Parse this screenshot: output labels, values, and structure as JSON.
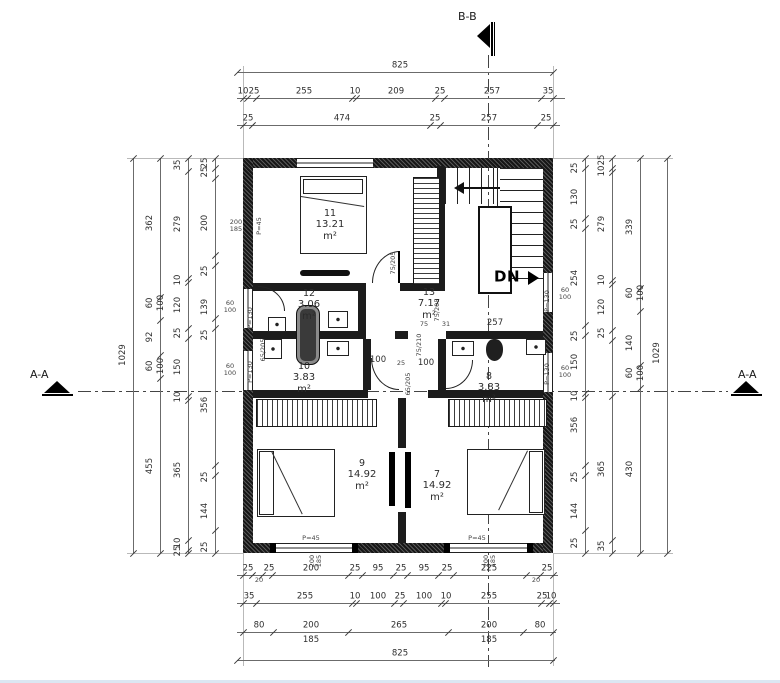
{
  "sections": {
    "bb": "B-B",
    "aa_left": "A-A",
    "aa_right": "A-A"
  },
  "colors": {
    "wall": "#161616",
    "dim_line": "#6b6b6b",
    "text": "#2e2e2e"
  },
  "stair": {
    "direction_label": "DN"
  },
  "rooms": [
    {
      "num": "11",
      "area": "13.21 m²",
      "x": 330,
      "y": 208
    },
    {
      "num": "12",
      "area": "3.06 m²",
      "x": 309,
      "y": 288
    },
    {
      "num": "13",
      "area": "7.17 m²",
      "x": 429,
      "y": 287
    },
    {
      "num": "10",
      "area": "3.83 m²",
      "x": 304,
      "y": 361
    },
    {
      "num": "8",
      "area": "3.83 m²",
      "x": 489,
      "y": 371
    },
    {
      "num": "9",
      "area": "14.92 m²",
      "x": 362,
      "y": 458
    },
    {
      "num": "7",
      "area": "14.92 m²",
      "x": 437,
      "y": 469
    }
  ],
  "dims": {
    "h": [
      {
        "y": 72,
        "x1": 237,
        "x2": 553,
        "ticks": [
          237,
          553
        ],
        "labels": [
          {
            "t": "825",
            "x": 400
          }
        ]
      },
      {
        "y": 98,
        "x1": 237,
        "x2": 565,
        "ticks": [
          243,
          247,
          256,
          352,
          356,
          435,
          444,
          541,
          553
        ],
        "labels": [
          {
            "t": "10",
            "x": 243
          },
          {
            "t": "25",
            "x": 254
          },
          {
            "t": "255",
            "x": 304
          },
          {
            "t": "10",
            "x": 355
          },
          {
            "t": "209",
            "x": 396
          },
          {
            "t": "25",
            "x": 440
          },
          {
            "t": "257",
            "x": 492
          },
          {
            "t": "35",
            "x": 548
          }
        ]
      },
      {
        "y": 125,
        "x1": 237,
        "x2": 560,
        "ticks": [
          243,
          252,
          430,
          440,
          537,
          553
        ],
        "labels": [
          {
            "t": "25",
            "x": 248
          },
          {
            "t": "474",
            "x": 342
          },
          {
            "t": "25",
            "x": 435
          },
          {
            "t": "257",
            "x": 489
          },
          {
            "t": "25",
            "x": 546
          }
        ]
      },
      {
        "y": 575,
        "x1": 237,
        "x2": 558,
        "ticks": [
          243,
          252,
          262,
          272,
          348,
          362,
          393,
          407,
          438,
          453,
          526,
          540,
          553
        ],
        "labels": [
          {
            "t": "25",
            "x": 248
          },
          {
            "t": "20",
            "x": 259,
            "dy": 2,
            "s": 1
          },
          {
            "t": "25",
            "x": 269
          },
          {
            "t": "200",
            "x": 311
          },
          {
            "t": "25",
            "x": 355
          },
          {
            "t": "95",
            "x": 378
          },
          {
            "t": "25",
            "x": 401
          },
          {
            "t": "95",
            "x": 424
          },
          {
            "t": "25",
            "x": 447
          },
          {
            "t": "225",
            "x": 489
          },
          {
            "t": "20",
            "x": 536,
            "dy": 2,
            "s": 1
          },
          {
            "t": "25",
            "x": 547
          }
        ]
      },
      {
        "y": 603,
        "x1": 237,
        "x2": 560,
        "ticks": [
          243,
          256,
          352,
          356,
          394,
          403,
          441,
          445,
          541,
          549,
          553
        ],
        "labels": [
          {
            "t": "35",
            "x": 249
          },
          {
            "t": "255",
            "x": 305
          },
          {
            "t": "10",
            "x": 355
          },
          {
            "t": "100",
            "x": 378
          },
          {
            "t": "25",
            "x": 400
          },
          {
            "t": "100",
            "x": 424
          },
          {
            "t": "10",
            "x": 446
          },
          {
            "t": "255",
            "x": 489
          },
          {
            "t": "25",
            "x": 542
          },
          {
            "t": "10",
            "x": 551
          }
        ]
      },
      {
        "y": 632,
        "x1": 237,
        "x2": 556,
        "ticks": [
          243,
          273,
          348,
          448,
          523,
          553
        ],
        "labels": [
          {
            "t": "80",
            "x": 259
          },
          {
            "t": "200",
            "x": 311
          },
          {
            "t": "185",
            "x": 311,
            "dy": 4
          },
          {
            "t": "265",
            "x": 399
          },
          {
            "t": "200",
            "x": 489
          },
          {
            "t": "185",
            "x": 489,
            "dy": 4
          },
          {
            "t": "80",
            "x": 540
          }
        ]
      },
      {
        "y": 660,
        "x1": 237,
        "x2": 555,
        "ticks": [
          237,
          553
        ],
        "labels": [
          {
            "t": "825",
            "x": 400
          }
        ]
      }
    ],
    "v": [
      {
        "x": 133,
        "y1": 158,
        "y2": 553,
        "ticks": [
          158,
          553
        ],
        "labels": [
          {
            "t": "1029",
            "y": 355
          }
        ]
      },
      {
        "x": 160,
        "y1": 158,
        "y2": 553,
        "ticks": [
          158,
          297,
          320,
          355,
          378,
          553
        ],
        "labels": [
          {
            "t": "362",
            "y": 223
          },
          {
            "t": "60",
            "y": 303
          },
          {
            "t": "100",
            "y": 303,
            "dx": 11
          },
          {
            "t": "92",
            "y": 337
          },
          {
            "t": "60",
            "y": 366
          },
          {
            "t": "100",
            "y": 366,
            "dx": 11
          },
          {
            "t": "455",
            "y": 466
          }
        ]
      },
      {
        "x": 188,
        "y1": 158,
        "y2": 553,
        "ticks": [
          158,
          171,
          278,
          282,
          328,
          338,
          396,
          400,
          540,
          550,
          553
        ],
        "labels": [
          {
            "t": "35",
            "y": 165
          },
          {
            "t": "279",
            "y": 224
          },
          {
            "t": "10",
            "y": 280
          },
          {
            "t": "120",
            "y": 305
          },
          {
            "t": "25",
            "y": 333
          },
          {
            "t": "150",
            "y": 367
          },
          {
            "t": "10",
            "y": 397
          },
          {
            "t": "365",
            "y": 470
          },
          {
            "t": "10",
            "y": 543
          },
          {
            "t": "25",
            "y": 551
          }
        ]
      },
      {
        "x": 215,
        "y1": 158,
        "y2": 553,
        "ticks": [
          158,
          168,
          178,
          255,
          265,
          318,
          328,
          465,
          475,
          530,
          553
        ],
        "labels": [
          {
            "t": "25",
            "y": 163
          },
          {
            "t": "25",
            "y": 172
          },
          {
            "t": "200",
            "y": 223
          },
          {
            "t": "25",
            "y": 271
          },
          {
            "t": "139",
            "y": 307
          },
          {
            "t": "25",
            "y": 335
          },
          {
            "t": "356",
            "y": 405
          },
          {
            "t": "25",
            "y": 477
          },
          {
            "t": "144",
            "y": 511
          },
          {
            "t": "25",
            "y": 547
          }
        ]
      },
      {
        "x": 585,
        "y1": 158,
        "y2": 553,
        "ticks": [
          158,
          168,
          218,
          228,
          325,
          335,
          393,
          397,
          465,
          475,
          530,
          553
        ],
        "labels": [
          {
            "t": "25",
            "y": 168
          },
          {
            "t": "130",
            "y": 197
          },
          {
            "t": "25",
            "y": 224
          },
          {
            "t": "254",
            "y": 278
          },
          {
            "t": "25",
            "y": 336
          },
          {
            "t": "150",
            "y": 362
          },
          {
            "t": "10",
            "y": 396
          },
          {
            "t": "356",
            "y": 425
          },
          {
            "t": "25",
            "y": 477
          },
          {
            "t": "144",
            "y": 511
          },
          {
            "t": "25",
            "y": 543
          }
        ]
      },
      {
        "x": 612,
        "y1": 158,
        "y2": 553,
        "ticks": [
          158,
          168,
          172,
          280,
          284,
          330,
          340,
          396,
          540,
          553
        ],
        "labels": [
          {
            "t": "25",
            "y": 160
          },
          {
            "t": "10",
            "y": 171
          },
          {
            "t": "279",
            "y": 224
          },
          {
            "t": "10",
            "y": 280
          },
          {
            "t": "120",
            "y": 307
          },
          {
            "t": "25",
            "y": 333
          },
          {
            "t": "365",
            "y": 469
          },
          {
            "t": "35",
            "y": 546
          }
        ]
      },
      {
        "x": 640,
        "y1": 158,
        "y2": 553,
        "ticks": [
          158,
          288,
          311,
          365,
          388,
          553
        ],
        "labels": [
          {
            "t": "339",
            "y": 227
          },
          {
            "t": "60",
            "y": 293
          },
          {
            "t": "100",
            "y": 293,
            "dx": 11
          },
          {
            "t": "140",
            "y": 343
          },
          {
            "t": "60",
            "y": 373
          },
          {
            "t": "100",
            "y": 373,
            "dx": 11
          },
          {
            "t": "430",
            "y": 469
          }
        ]
      },
      {
        "x": 667,
        "y1": 158,
        "y2": 553,
        "ticks": [
          158,
          553
        ],
        "labels": [
          {
            "t": "1029",
            "y": 353
          }
        ]
      }
    ]
  },
  "labels": [
    {
      "t": "257",
      "x": 495,
      "y": 323
    },
    {
      "t": "75",
      "x": 424,
      "y": 324,
      "s": 1
    },
    {
      "t": "31",
      "x": 446,
      "y": 324,
      "s": 1
    },
    {
      "t": "100",
      "x": 378,
      "y": 360
    },
    {
      "t": "25",
      "x": 401,
      "y": 363,
      "s": 1
    },
    {
      "t": "100",
      "x": 426,
      "y": 363
    },
    {
      "t": "P=45",
      "x": 259,
      "y": 226,
      "r": 1,
      "s": 1
    },
    {
      "t": "P=130",
      "x": 250,
      "y": 318,
      "r": 1,
      "s": 1
    },
    {
      "t": "P=130",
      "x": 250,
      "y": 372,
      "r": 1,
      "s": 1
    },
    {
      "t": "P=130",
      "x": 547,
      "y": 301,
      "r": 1,
      "s": 1
    },
    {
      "t": "P=130",
      "x": 547,
      "y": 374,
      "r": 1,
      "s": 1
    },
    {
      "t": "P=45",
      "x": 311,
      "y": 538,
      "s": 1
    },
    {
      "t": "P=45",
      "x": 477,
      "y": 538,
      "s": 1
    },
    {
      "t": "200",
      "x": 236,
      "y": 222,
      "s": 1
    },
    {
      "t": "185",
      "x": 236,
      "y": 229,
      "s": 1
    },
    {
      "t": "60",
      "x": 230,
      "y": 303,
      "s": 1
    },
    {
      "t": "100",
      "x": 230,
      "y": 310,
      "s": 1
    },
    {
      "t": "60",
      "x": 230,
      "y": 366,
      "s": 1
    },
    {
      "t": "100",
      "x": 230,
      "y": 373,
      "s": 1
    },
    {
      "t": "60",
      "x": 565,
      "y": 290,
      "s": 1
    },
    {
      "t": "100",
      "x": 565,
      "y": 297,
      "s": 1
    },
    {
      "t": "60",
      "x": 565,
      "y": 368,
      "s": 1
    },
    {
      "t": "100",
      "x": 565,
      "y": 375,
      "s": 1
    },
    {
      "t": "200",
      "x": 312,
      "y": 561,
      "r": 1,
      "s": 1
    },
    {
      "t": "185",
      "x": 319,
      "y": 561,
      "r": 1,
      "s": 1
    },
    {
      "t": "200",
      "x": 486,
      "y": 561,
      "r": 1,
      "s": 1
    },
    {
      "t": "185",
      "x": 493,
      "y": 561,
      "r": 1,
      "s": 1
    },
    {
      "t": "75/205",
      "x": 393,
      "y": 263,
      "r": 1,
      "s": 1
    },
    {
      "t": "65/205",
      "x": 263,
      "y": 350,
      "r": 1,
      "s": 1
    },
    {
      "t": "75/205",
      "x": 437,
      "y": 310,
      "r": 1,
      "s": 1
    },
    {
      "t": "75/210",
      "x": 419,
      "y": 345,
      "r": 1,
      "s": 1
    },
    {
      "t": "65/205",
      "x": 408,
      "y": 384,
      "r": 1,
      "s": 1
    },
    {
      "t": "DN",
      "x": 507,
      "y": 277,
      "b": 1
    }
  ]
}
